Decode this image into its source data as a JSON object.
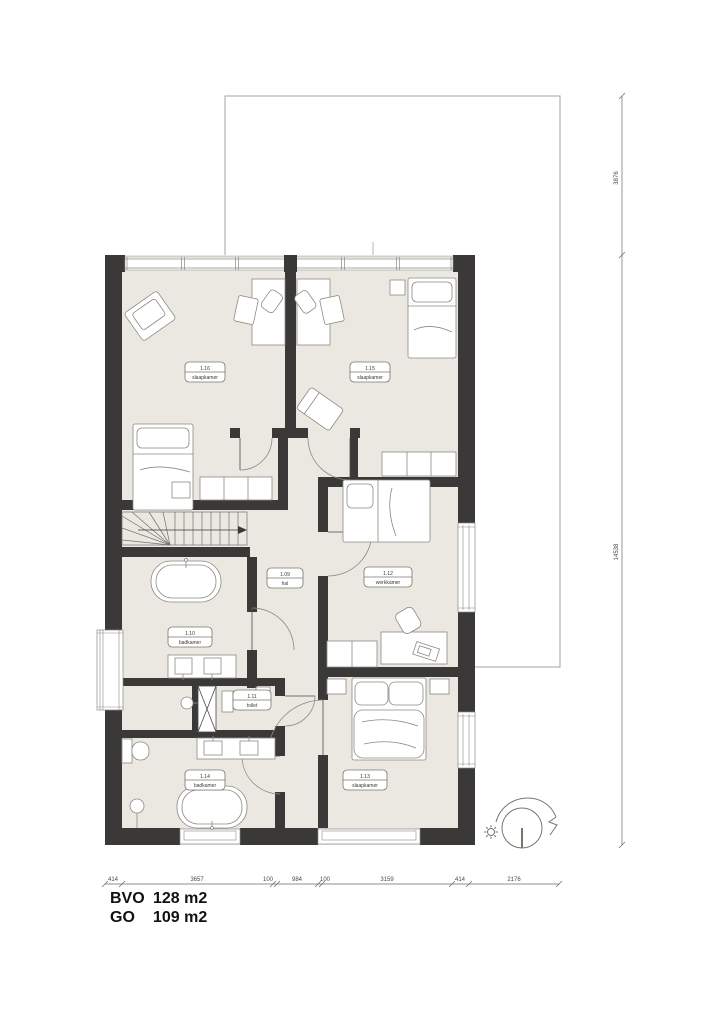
{
  "rooms": [
    {
      "number": "1.16",
      "name": "slaapkamer"
    },
    {
      "number": "1.15",
      "name": "slaapkamer"
    },
    {
      "number": "1.09",
      "name": "hal"
    },
    {
      "number": "1.12",
      "name": "werkkamer"
    },
    {
      "number": "1.10",
      "name": "badkamer"
    },
    {
      "number": "1.11",
      "name": "toilet"
    },
    {
      "number": "1.13",
      "name": "slaapkamer"
    },
    {
      "number": "1.14",
      "name": "badkamer"
    }
  ],
  "dimensions": {
    "bottom": [
      "414",
      "3657",
      "100",
      "984",
      "100",
      "3159",
      "414",
      "2176"
    ],
    "right": [
      "3876",
      "14538"
    ]
  },
  "areas": [
    {
      "label": "BVO",
      "value": "128 m2"
    },
    {
      "label": "GO",
      "value": "109 m2"
    }
  ],
  "colors": {
    "wall": "#3a3938",
    "floor": "#ebe8e1",
    "line": "#8a8a83"
  }
}
